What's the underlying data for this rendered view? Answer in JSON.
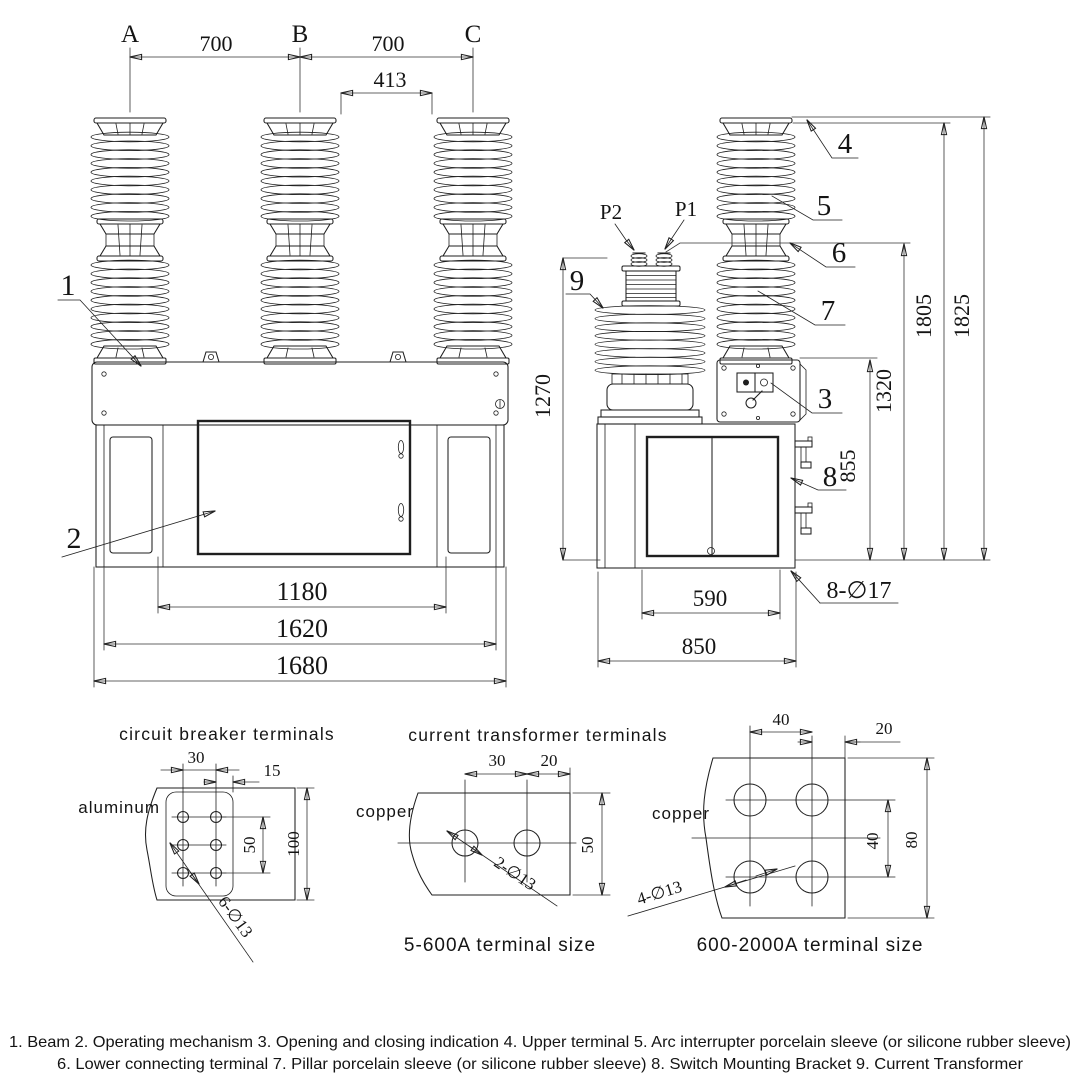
{
  "colors": {
    "ink": "#1f1f1f",
    "background": "#ffffff"
  },
  "front": {
    "phase_a": "A",
    "phase_b": "B",
    "phase_c": "C",
    "dim_ab": "700",
    "dim_bc": "700",
    "dim_gap": "413",
    "dim_inner": "1180",
    "dim_frame": "1620",
    "dim_overall": "1680",
    "label_beam": "1",
    "label_mechanism": "2"
  },
  "side": {
    "label_p2": "P2",
    "label_p1": "P1",
    "label_upper_terminal": "4",
    "label_arc_sleeve": "5",
    "label_lower_terminal": "6",
    "label_pillar_sleeve": "7",
    "label_indication": "3",
    "label_bracket": "8",
    "label_ct": "9",
    "dim_ct_height": "1270",
    "dim_bracket": "855",
    "dim_terminal": "1320",
    "dim_height_1": "1805",
    "dim_height_2": "1825",
    "dim_door": "590",
    "dim_base": "850",
    "mounting_holes": "8-∅17"
  },
  "detail_cb": {
    "title": "circuit breaker terminals",
    "material": "aluminum",
    "dim_w1": "30",
    "dim_w2": "15",
    "dim_h1": "50",
    "dim_h2": "100",
    "holes": "6-∅13"
  },
  "detail_ct": {
    "title": "current transformer terminals",
    "material": "copper",
    "dim_w1": "30",
    "dim_w2": "20",
    "dim_h1": "50",
    "holes": "2-∅13",
    "caption": "5-600A terminal size"
  },
  "detail_big": {
    "material": "copper",
    "dim_w1": "40",
    "dim_w2": "20",
    "dim_h1": "40",
    "dim_h2": "80",
    "holes": "4-∅13",
    "caption": "600-2000A terminal size"
  },
  "legend": {
    "line1": "1. Beam 2. Operating mechanism 3. Opening and closing indication 4. Upper terminal 5. Arc interrupter porcelain sleeve (or silicone rubber sleeve)",
    "line2": "6. Lower connecting terminal 7. Pillar porcelain sleeve (or silicone rubber sleeve) 8. Switch Mounting Bracket 9. Current Transformer"
  }
}
